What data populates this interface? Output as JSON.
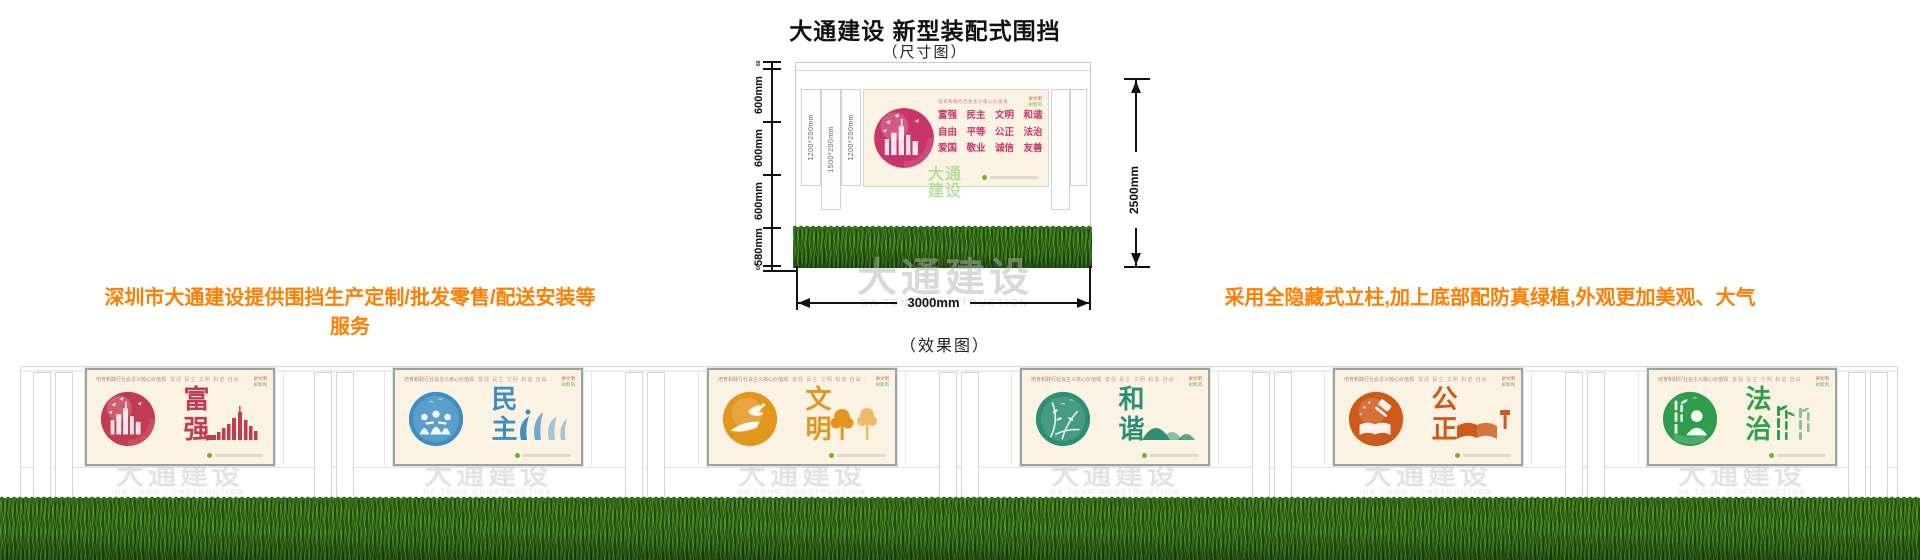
{
  "header": {
    "title": "大通建设 新型装配式围挡",
    "size_diagram_label": "（尺寸图）",
    "effect_diagram_label": "（效果图）"
  },
  "notes": {
    "left": "深圳市大通建设提供围挡生产定制/批发零售/配送安装等服务",
    "right": "采用全隐藏式立柱,加上底部配防真绿植,外观更加美观、大气",
    "accent_color": "#ff7e00"
  },
  "watermark": {
    "cn": "大通建设",
    "en": "DA TONG CONSTRUCTION"
  },
  "dimension_diagram": {
    "vertical_dims": [
      "60",
      "600mm",
      "600mm",
      "600mm",
      "580mm",
      "60"
    ],
    "post_labels": [
      "1200*200mm",
      "1500*200mm",
      "1200*200mm"
    ],
    "total_height": "2500mm",
    "total_width": "3000mm",
    "logo_lines": [
      "大通",
      "建设"
    ],
    "panel": {
      "slogan_header": "培育和践行社会主义核心价值观",
      "value_rows": [
        "富强　民主　文明　和谐",
        "自由　平等　公正　法治",
        "爱国　敬业　诚信　友善"
      ],
      "corner_lines": [
        "讲文明",
        "树新风"
      ],
      "accent_color": "#c9356b"
    }
  },
  "effect_common": {
    "slogan_header": "培育和践行社会主义核心价值观",
    "values_inline": "富强 民主 文明 和谐 自由 平等 公正 法治 爱国 敬业 诚信 友善",
    "corner_lines": [
      "讲文明",
      "树新风"
    ]
  },
  "effect_panels": [
    {
      "title": "富强",
      "accent_color": "#c23a53",
      "icon": "city-skyline"
    },
    {
      "title": "民主",
      "accent_color": "#3f8ec2",
      "icon": "people-circle"
    },
    {
      "title": "文明",
      "accent_color": "#e3961d",
      "icon": "hand-dove"
    },
    {
      "title": "和谐",
      "accent_color": "#2e8e74",
      "icon": "branches-birds"
    },
    {
      "title": "公正",
      "accent_color": "#cd5a1b",
      "icon": "book-gavel"
    },
    {
      "title": "法治",
      "accent_color": "#2f9e4c",
      "icon": "bamboo-figure"
    }
  ]
}
